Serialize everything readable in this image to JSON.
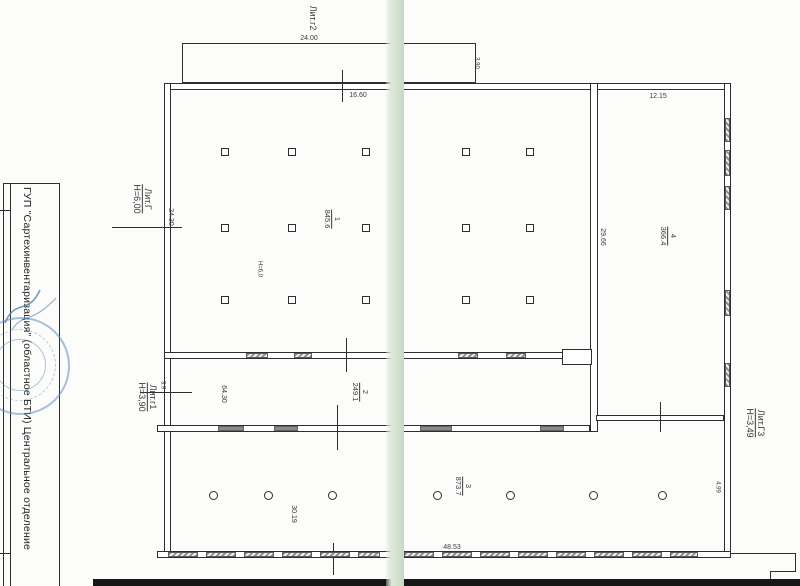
{
  "org_strip": {
    "text": "ГУП \"Сартехинвентаризация\" (областное БТИ) Центральное отделение"
  },
  "stamp": {
    "name": "round-seal",
    "color": "#5a8cbf"
  },
  "buildings": {
    "g2": {
      "label": "Лит.г2"
    },
    "g": {
      "label": "Лит.Г",
      "height": "Н=6,00"
    },
    "g1": {
      "label": "Лит.г1",
      "height": "Н=3,90"
    },
    "g3": {
      "label": "Лит.Г3",
      "height": "Н=3,49"
    }
  },
  "rooms": {
    "r1": {
      "num": "1",
      "area": "845.6",
      "note": "Н=6,0"
    },
    "r2": {
      "num": "2",
      "area": "249.1"
    },
    "r3": {
      "num": "3",
      "area": "873.7"
    },
    "r4": {
      "num": "4",
      "area": "366.4"
    }
  },
  "dimensions": {
    "annex_width": "24.00",
    "annex_depth": "3.90",
    "top_offset": "16.60",
    "left_height": "24.30",
    "corridor_left": "3.9",
    "corridor_length": "64.30",
    "room3_dim": "30.19",
    "bottom_length": "48.53",
    "g3_width": "12.15",
    "g3_side_height": "29.66",
    "g3_lower_side": "4.99"
  },
  "colors": {
    "ink": "#2e2e2e",
    "stamp_blue": "#5a8cbf",
    "fold_green": "#d5e1d2"
  }
}
